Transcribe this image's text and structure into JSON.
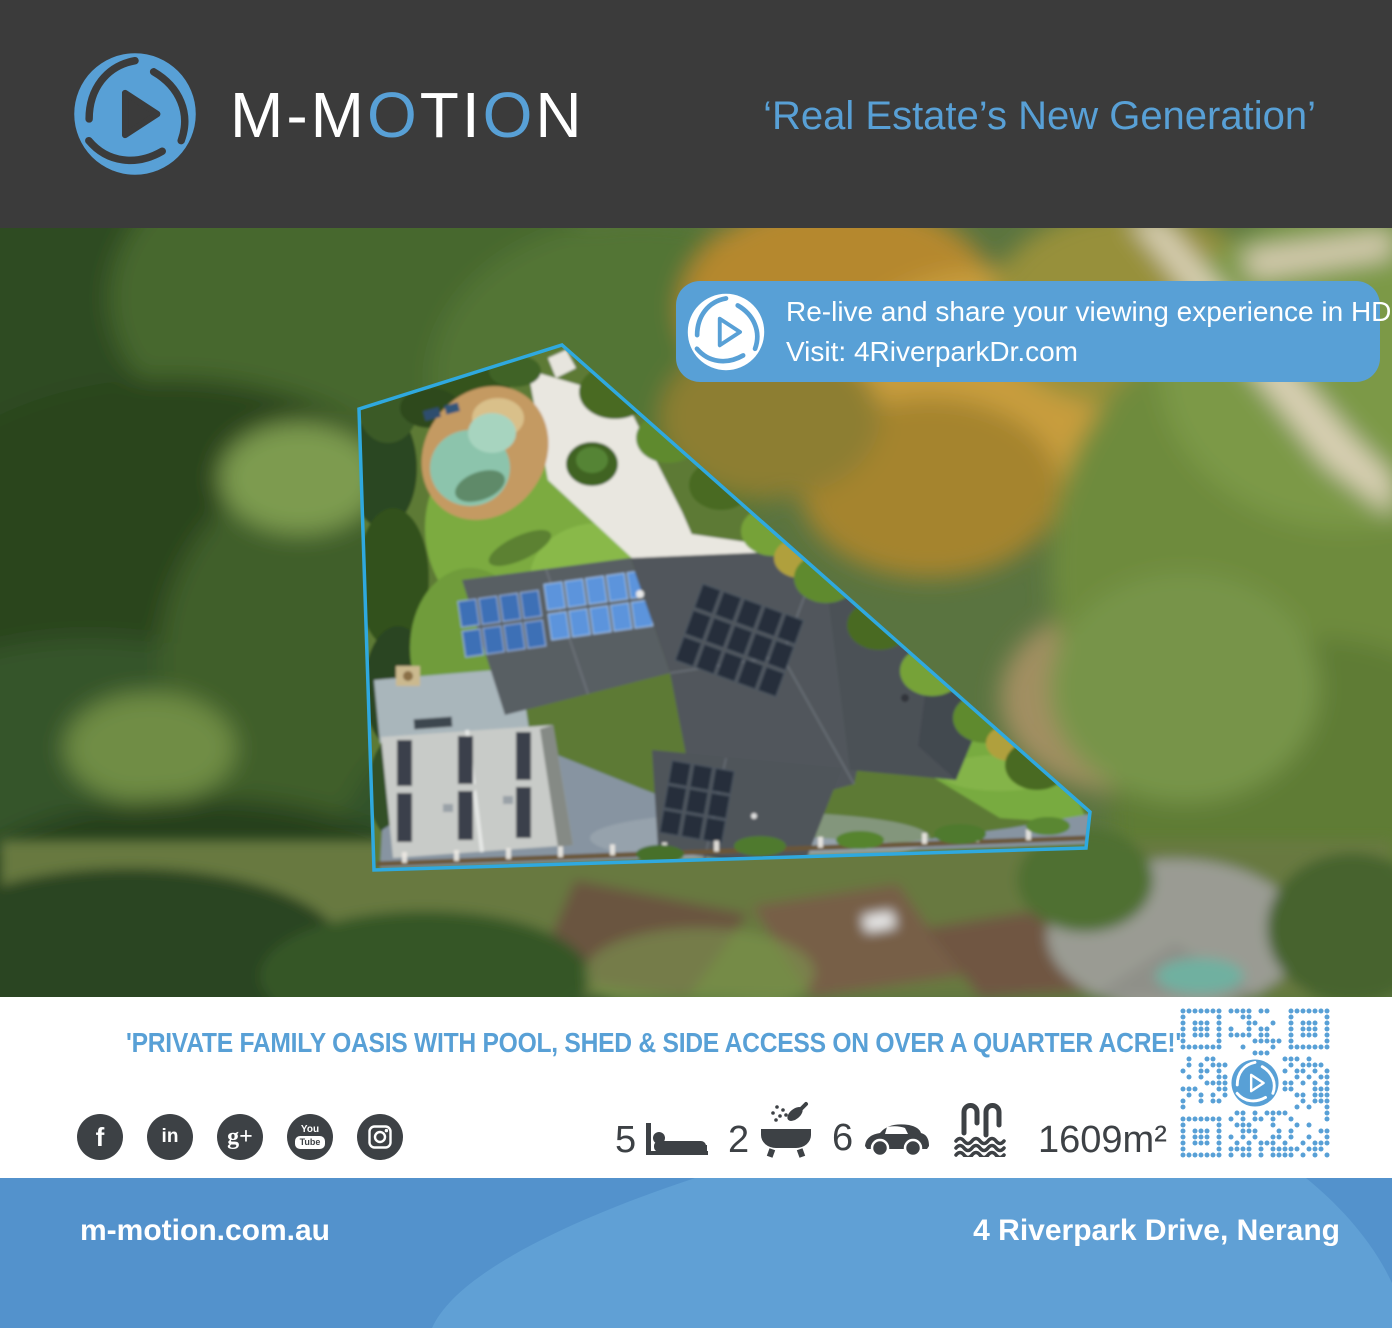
{
  "colors": {
    "accent": "#58A0D6",
    "header_bg": "#3B3B3B",
    "boundary_line": "#2FA9DF",
    "footer_bg": "#5392CC",
    "footer_swoosh": "#60A0D5",
    "stat_color": "#3d4145"
  },
  "header": {
    "brand_parts": [
      {
        "text": "M-M"
      },
      {
        "text": "O"
      },
      {
        "text": "TI"
      },
      {
        "text": "O"
      },
      {
        "text": "N"
      }
    ],
    "tagline": "‘Real Estate’s New Generation’"
  },
  "banner": {
    "line1": "Re-live and share your viewing experience in HD",
    "line2": "Visit: 4RiverparkDr.com"
  },
  "headline": "'PRIVATE FAMILY OASIS WITH POOL, SHED & SIDE ACCESS ON OVER A QUARTER ACRE!'",
  "social": [
    {
      "name": "facebook",
      "glyph": "f"
    },
    {
      "name": "linkedin",
      "glyph": "in"
    },
    {
      "name": "google-plus",
      "glyph": "g+"
    },
    {
      "name": "youtube",
      "glyph_top": "You",
      "glyph_bottom": "Tube"
    },
    {
      "name": "instagram"
    }
  ],
  "stats": {
    "beds": "5",
    "baths": "2",
    "cars": "6",
    "area": "1609m²"
  },
  "footer": {
    "website": "m-motion.com.au",
    "address": "4 Riverpark Drive, Nerang"
  }
}
